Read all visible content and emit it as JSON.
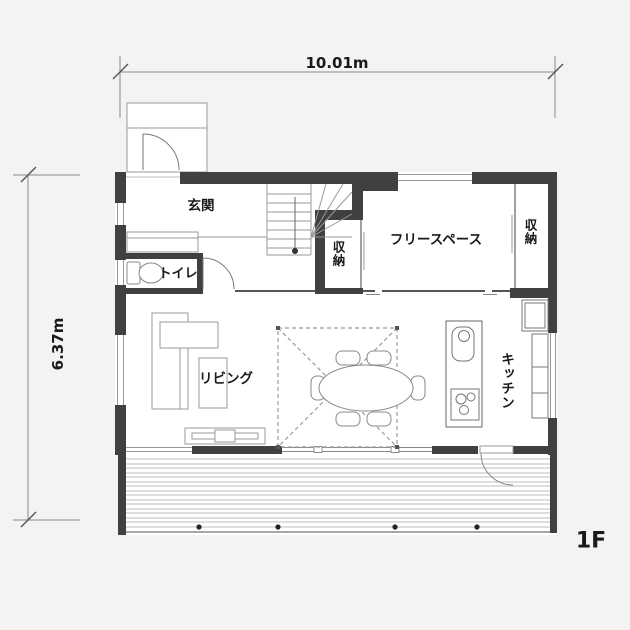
{
  "colors": {
    "background": "#f4f3f2",
    "wall": "#404040",
    "floor_interior": "#ffffff",
    "text": "#1a1a1a",
    "thin_line": "#999999"
  },
  "dimensions": {
    "width_label": "10.01m",
    "height_label": "6.37m"
  },
  "floor": {
    "label": "1F"
  },
  "rooms": {
    "genkan": "玄関",
    "toilet": "トイレ",
    "storage_left": "収納",
    "free_space": "フリースペース",
    "storage_right": "収納",
    "living": "リビング",
    "kitchen": "キッチン"
  }
}
